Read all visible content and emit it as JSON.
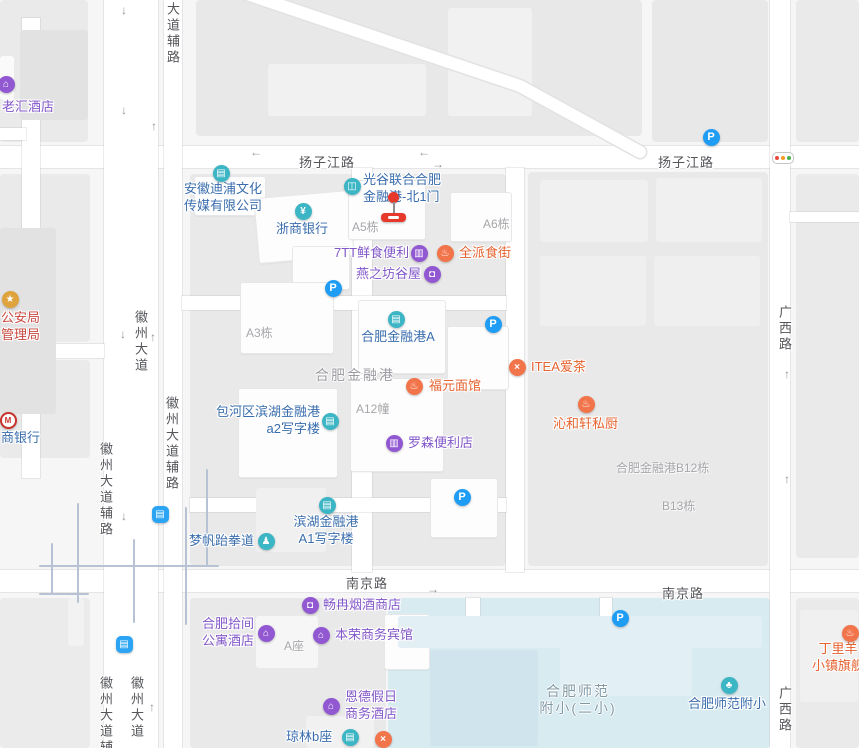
{
  "app": {
    "name": "map-view"
  },
  "colors": {
    "background": "#f6f6f7",
    "block": "#eaeaeb",
    "road": "#ffffff",
    "school_area": "#d8ebf1",
    "alley_line": "#b7c2d4",
    "poi_blue": "#3a6dad",
    "poi_purple": "#8257c8",
    "poi_orange": "#e5622f",
    "poi_red": "#c8473e",
    "icon_teal": "#3cb5c4",
    "icon_purple": "#9158d2",
    "icon_orange": "#f2744b",
    "icon_parking_blue": "#1f9cf3",
    "icon_bus_blue": "#2ba4f4",
    "icon_gov_gold": "#dfa33d",
    "marker_red": "#e6382b"
  },
  "road_labels": [
    {
      "name": "yangzijiang-road-label-west",
      "text": "扬子江路",
      "x": 299,
      "y": 160,
      "vertical": false
    },
    {
      "name": "yangzijiang-road-label-east",
      "text": "扬子江路",
      "x": 658,
      "y": 160,
      "vertical": false
    },
    {
      "name": "nanjing-road-label-west",
      "text": "南京路",
      "x": 346,
      "y": 581,
      "vertical": false
    },
    {
      "name": "nanjing-road-label-east",
      "text": "南京路",
      "x": 662,
      "y": 591,
      "vertical": false
    },
    {
      "name": "huizhou-avenue-label-mid",
      "text": "徽州大道",
      "x": 139,
      "y": 310,
      "vertical": true
    },
    {
      "name": "huizhou-avenue-label-south",
      "text": "徽州大道",
      "x": 135,
      "y": 676,
      "vertical": true
    },
    {
      "name": "huizhou-aux-road-label-top",
      "text": "大道辅路",
      "x": 171,
      "y": 2,
      "vertical": true
    },
    {
      "name": "huizhou-aux-road-label-mid-east",
      "text": "徽州大道辅路",
      "x": 170,
      "y": 396,
      "vertical": true
    },
    {
      "name": "huizhou-aux-road-label-mid-west",
      "text": "徽州大道辅路",
      "x": 104,
      "y": 442,
      "vertical": true
    },
    {
      "name": "huizhou-aux-road-label-south",
      "text": "徽州大道辅路",
      "x": 104,
      "y": 676,
      "vertical": true
    },
    {
      "name": "guangxi-road-label-mid",
      "text": "广西路",
      "x": 783,
      "y": 305,
      "vertical": true
    },
    {
      "name": "guangxi-road-label-south",
      "text": "广西路",
      "x": 783,
      "y": 686,
      "vertical": true
    }
  ],
  "area_labels": [
    {
      "name": "jinronggang-area-label",
      "lines": [
        "合肥金融港"
      ],
      "x": 315,
      "y": 374,
      "size": 14,
      "align": "left",
      "cls": ""
    },
    {
      "name": "school-area-label",
      "lines": [
        "合肥师范",
        "附小(二小)"
      ],
      "x": 578,
      "y": 690,
      "size": 14,
      "align": "center",
      "cls": "c-school"
    }
  ],
  "building_labels": [
    {
      "name": "building-label-a5",
      "text": "A5栋",
      "x": 352,
      "y": 225
    },
    {
      "name": "building-label-a6",
      "text": "A6栋",
      "x": 483,
      "y": 222
    },
    {
      "name": "building-label-a3",
      "text": "A3栋",
      "x": 246,
      "y": 331
    },
    {
      "name": "building-label-a12",
      "text": "A12幢",
      "x": 356,
      "y": 407
    },
    {
      "name": "building-label-b12",
      "text": "合肥金融港B12栋",
      "x": 616,
      "y": 466
    },
    {
      "name": "building-label-b13",
      "text": "B13栋",
      "x": 662,
      "y": 504
    },
    {
      "name": "building-label-a-zuo",
      "text": "A座",
      "x": 284,
      "y": 644
    }
  ],
  "pois": [
    {
      "name": "poi-laohui-hotel",
      "lines": [
        "老汇酒店"
      ],
      "tx": 2,
      "ty": 107,
      "align": "left",
      "cls": "c-purple",
      "icon": {
        "type": "hotel",
        "style": "purple",
        "x": 6,
        "y": 84
      }
    },
    {
      "name": "poi-anhui-dipu-media",
      "lines": [
        "安徽迪浦文化",
        "传媒有限公司"
      ],
      "tx": 184,
      "ty": 189,
      "align": "left",
      "cls": "c-blue",
      "icon": {
        "type": "company",
        "style": "teal",
        "x": 221,
        "y": 173
      }
    },
    {
      "name": "poi-zheshang-bank",
      "lines": [
        "浙商银行"
      ],
      "tx": 302,
      "ty": 229,
      "align": "center",
      "cls": "c-blue",
      "icon": {
        "type": "bank",
        "style": "teal",
        "x": 303,
        "y": 211
      }
    },
    {
      "name": "poi-guanggu-north-gate",
      "lines": [
        "光谷联合合肥",
        "金融港-北1门"
      ],
      "tx": 363,
      "ty": 180,
      "align": "left",
      "cls": "c-blue",
      "icon": {
        "type": "entrance",
        "style": "teal",
        "x": 352,
        "y": 186
      }
    },
    {
      "name": "poi-7tt-convenience",
      "lines": [
        "7TT鲜食便利"
      ],
      "tx": 334,
      "ty": 253,
      "align": "left",
      "cls": "c-purple",
      "icon": {
        "type": "convenience",
        "style": "purple",
        "x": 419,
        "y": 253
      }
    },
    {
      "name": "poi-quanpai-food-street",
      "lines": [
        "全派食街"
      ],
      "tx": 459,
      "ty": 253,
      "align": "left",
      "cls": "c-orange",
      "icon": {
        "type": "food",
        "style": "orange",
        "x": 445,
        "y": 253
      }
    },
    {
      "name": "poi-yanzhifang-guwu",
      "lines": [
        "燕之坊谷屋"
      ],
      "tx": 356,
      "ty": 274,
      "align": "left",
      "cls": "c-purple",
      "icon": {
        "type": "bag",
        "style": "purple",
        "x": 432,
        "y": 274
      }
    },
    {
      "name": "poi-jinronggang-a",
      "lines": [
        "合肥金融港A"
      ],
      "tx": 398,
      "ty": 337,
      "align": "center",
      "cls": "c-blue",
      "icon": {
        "type": "office",
        "style": "teal",
        "x": 396,
        "y": 319
      }
    },
    {
      "name": "poi-baohe-a2-office",
      "lines": [
        "包河区滨湖金融港",
        "a2写字楼"
      ],
      "tx": 320,
      "ty": 412,
      "align": "right",
      "cls": "c-blue",
      "icon": {
        "type": "office",
        "style": "teal",
        "x": 330,
        "y": 421
      }
    },
    {
      "name": "poi-fuyuan-noodle",
      "lines": [
        "福元面馆"
      ],
      "tx": 429,
      "ty": 386,
      "align": "left",
      "cls": "c-orange",
      "icon": {
        "type": "food",
        "style": "orange",
        "x": 414,
        "y": 386
      }
    },
    {
      "name": "poi-itea",
      "lines": [
        "ITEA爱茶"
      ],
      "tx": 531,
      "ty": 367,
      "align": "left",
      "cls": "c-orange",
      "icon": {
        "type": "tea",
        "style": "orange",
        "x": 517,
        "y": 367
      }
    },
    {
      "name": "poi-qinhexuan-kitchen",
      "lines": [
        "沁和轩私厨"
      ],
      "tx": 553,
      "ty": 424,
      "align": "left",
      "cls": "c-orange",
      "icon": {
        "type": "food",
        "style": "orange",
        "x": 586,
        "y": 404
      }
    },
    {
      "name": "poi-lawson",
      "lines": [
        "罗森便利店"
      ],
      "tx": 408,
      "ty": 443,
      "align": "left",
      "cls": "c-purple",
      "icon": {
        "type": "convenience",
        "style": "purple",
        "x": 394,
        "y": 443
      }
    },
    {
      "name": "poi-mengfan-taekwondo",
      "lines": [
        "梦帆跆拳道"
      ],
      "tx": 189,
      "ty": 541,
      "align": "left",
      "cls": "c-blue",
      "icon": {
        "type": "taekwondo",
        "style": "teal",
        "x": 266,
        "y": 541
      }
    },
    {
      "name": "poi-binhu-a1-office",
      "lines": [
        "滨湖金融港",
        "A1写字楼"
      ],
      "tx": 326,
      "ty": 522,
      "align": "center",
      "cls": "c-blue",
      "icon": {
        "type": "office",
        "style": "teal",
        "x": 327,
        "y": 505
      }
    },
    {
      "name": "poi-changran-tobacco",
      "lines": [
        "畅冉烟酒商店"
      ],
      "tx": 323,
      "ty": 605,
      "align": "left",
      "cls": "c-purple",
      "icon": {
        "type": "bag",
        "style": "purple",
        "x": 310,
        "y": 605
      }
    },
    {
      "name": "poi-hefei-shijian-apartment",
      "lines": [
        "合肥拾间",
        "公寓酒店"
      ],
      "tx": 254,
      "ty": 624,
      "align": "right",
      "cls": "c-purple",
      "icon": {
        "type": "hotel",
        "style": "purple",
        "x": 266,
        "y": 633
      }
    },
    {
      "name": "poi-benrong-hotel",
      "lines": [
        "本荣商务宾馆"
      ],
      "tx": 335,
      "ty": 635,
      "align": "left",
      "cls": "c-purple",
      "icon": {
        "type": "hotel",
        "style": "purple",
        "x": 321,
        "y": 635
      }
    },
    {
      "name": "poi-ende-hotel",
      "lines": [
        "恩德假日",
        "商务酒店"
      ],
      "tx": 345,
      "ty": 697,
      "align": "left",
      "cls": "c-purple",
      "icon": {
        "type": "hotel",
        "style": "purple",
        "x": 331,
        "y": 706
      }
    },
    {
      "name": "poi-qionglin-b",
      "lines": [
        "琼林b座"
      ],
      "tx": 286,
      "ty": 737,
      "align": "left",
      "cls": "c-blue",
      "icon": {
        "type": "office",
        "style": "teal",
        "x": 350,
        "y": 737
      }
    },
    {
      "name": "poi-restaurant-cutoff",
      "lines": [],
      "tx": 0,
      "ty": 0,
      "align": "left",
      "cls": "c-orange",
      "icon": {
        "type": "tea",
        "style": "orange",
        "x": 383,
        "y": 739
      }
    },
    {
      "name": "poi-dingliyang-flagship",
      "lines": [
        "丁里羊",
        "小镇旗舰"
      ],
      "tx": 838,
      "ty": 649,
      "align": "center",
      "cls": "c-orange",
      "icon": {
        "type": "food",
        "style": "orange",
        "x": 850,
        "y": 633
      }
    },
    {
      "name": "poi-hefei-shifan-fuxiao",
      "lines": [
        "合肥师范附小"
      ],
      "tx": 688,
      "ty": 704,
      "align": "left",
      "cls": "c-blue",
      "icon": {
        "type": "school",
        "style": "teal",
        "x": 729,
        "y": 685
      }
    },
    {
      "name": "poi-public-security-bureau",
      "lines": [
        "公安局",
        "管理局"
      ],
      "tx": 1,
      "ty": 318,
      "align": "left",
      "cls": "c-red",
      "icon": {
        "type": "gov",
        "style": "gold",
        "x": 10,
        "y": 299
      }
    },
    {
      "name": "poi-zhaoshang-bank",
      "lines": [
        "商银行"
      ],
      "tx": 1,
      "ty": 438,
      "align": "left",
      "cls": "c-blue",
      "icon": {
        "type": "cmb",
        "style": "cmb",
        "x": 8,
        "y": 420
      }
    }
  ],
  "badges": [
    {
      "name": "parking-icon-yangzijiang",
      "type": "parking",
      "x": 711,
      "y": 137
    },
    {
      "name": "parking-icon-yanzhifang",
      "type": "parking",
      "x": 333,
      "y": 288
    },
    {
      "name": "parking-icon-jinronggang-a",
      "type": "parking",
      "x": 493,
      "y": 324
    },
    {
      "name": "parking-icon-binhu",
      "type": "parking",
      "x": 462,
      "y": 497
    },
    {
      "name": "parking-icon-school",
      "type": "parking",
      "x": 620,
      "y": 618
    },
    {
      "name": "bus-stop-icon-huizhou-mid",
      "type": "bus",
      "x": 160,
      "y": 514
    },
    {
      "name": "bus-stop-icon-huizhou-south",
      "type": "bus",
      "x": 124,
      "y": 644
    }
  ],
  "arrows": [
    {
      "glyph": "↓",
      "x": 121,
      "y": 4
    },
    {
      "glyph": "↓",
      "x": 121,
      "y": 104
    },
    {
      "glyph": "↑",
      "x": 151,
      "y": 120
    },
    {
      "glyph": "↓",
      "x": 120,
      "y": 328
    },
    {
      "glyph": "↑",
      "x": 150,
      "y": 331
    },
    {
      "glyph": "↓",
      "x": 121,
      "y": 510
    },
    {
      "glyph": "↑",
      "x": 149,
      "y": 701
    },
    {
      "glyph": "←",
      "x": 250,
      "y": 146
    },
    {
      "glyph": "←",
      "x": 418,
      "y": 146
    },
    {
      "glyph": "→",
      "x": 432,
      "y": 158
    },
    {
      "glyph": "→",
      "x": 427,
      "y": 583
    },
    {
      "glyph": "↑",
      "x": 784,
      "y": 368
    },
    {
      "glyph": "↑",
      "x": 784,
      "y": 473
    }
  ],
  "marker": {
    "name": "destination-marker",
    "x": 381,
    "y": 192
  },
  "traffic_signal": {
    "name": "traffic-signal-icon",
    "x": 772,
    "y": 152,
    "dot_colors": [
      "#e5493f",
      "#f59a23",
      "#4caf50"
    ]
  },
  "geometry": {
    "blocks": [
      [
        0,
        0,
        88,
        142,
        "#eaeaeb"
      ],
      [
        196,
        0,
        446,
        136,
        "#e8e8e9"
      ],
      [
        652,
        0,
        116,
        142,
        "#e8e8e9"
      ],
      [
        796,
        0,
        63,
        142,
        "#eaeaeb"
      ],
      [
        0,
        174,
        90,
        168,
        "#eaeaeb"
      ],
      [
        0,
        360,
        90,
        98,
        "#eaeaeb"
      ],
      [
        190,
        174,
        316,
        392,
        "#e9e9ea"
      ],
      [
        528,
        172,
        240,
        394,
        "#e9e9ea"
      ],
      [
        796,
        174,
        63,
        384,
        "#eaeaeb"
      ],
      [
        0,
        598,
        90,
        150,
        "#ebebec"
      ],
      [
        190,
        598,
        196,
        150,
        "#e9e9ea"
      ],
      [
        796,
        598,
        63,
        150,
        "#eaeaeb"
      ],
      [
        388,
        598,
        382,
        150,
        "#d8ebf1"
      ]
    ],
    "buildings": [
      [
        268,
        64,
        158,
        52,
        "#f1f1f2",
        0
      ],
      [
        448,
        8,
        84,
        108,
        "#f1f1f2",
        0
      ],
      [
        20,
        30,
        68,
        90,
        "#e2e2e3",
        0
      ],
      [
        0,
        56,
        14,
        44,
        "#fafafa",
        0
      ],
      [
        0,
        228,
        56,
        186,
        "#e2e2e3",
        0
      ],
      [
        194,
        176,
        70,
        38,
        "white",
        0
      ],
      [
        256,
        194,
        94,
        64,
        "white",
        -5
      ],
      [
        348,
        180,
        76,
        58,
        "white",
        0
      ],
      [
        450,
        192,
        60,
        48,
        "white",
        0
      ],
      [
        292,
        246,
        56,
        42,
        "white",
        0
      ],
      [
        240,
        282,
        92,
        70,
        "white",
        0
      ],
      [
        358,
        300,
        86,
        72,
        "white",
        0
      ],
      [
        447,
        326,
        60,
        62,
        "white",
        0
      ],
      [
        350,
        378,
        92,
        92,
        "white",
        0
      ],
      [
        238,
        388,
        98,
        88,
        "white",
        0
      ],
      [
        256,
        488,
        70,
        64,
        "#f0f0f1",
        0
      ],
      [
        430,
        478,
        66,
        58,
        "white",
        0
      ],
      [
        540,
        180,
        108,
        62,
        "#f0f0f1",
        0
      ],
      [
        656,
        178,
        106,
        64,
        "#f0f0f1",
        0
      ],
      [
        540,
        256,
        106,
        70,
        "#efeff0",
        0
      ],
      [
        654,
        256,
        106,
        70,
        "#efeff0",
        0
      ],
      [
        256,
        616,
        62,
        52,
        "#f6f6f7",
        0
      ],
      [
        384,
        614,
        44,
        54,
        "white",
        0
      ],
      [
        306,
        716,
        68,
        32,
        "#f1f1f2",
        0
      ],
      [
        800,
        610,
        58,
        92,
        "#f0f0f1",
        0
      ],
      [
        68,
        598,
        16,
        48,
        "#f2f2f3",
        0
      ],
      [
        398,
        616,
        364,
        32,
        "#e2eff5",
        0
      ],
      [
        430,
        650,
        108,
        96,
        "#cfe4ec",
        0
      ],
      [
        560,
        626,
        132,
        70,
        "#e2eff5",
        0
      ]
    ],
    "roads": [
      [
        0,
        146,
        859,
        22
      ],
      [
        0,
        570,
        859,
        22
      ],
      [
        104,
        0,
        54,
        748
      ],
      [
        164,
        0,
        18,
        748
      ],
      [
        22,
        18,
        18,
        460
      ],
      [
        770,
        0,
        20,
        748
      ],
      [
        352,
        168,
        20,
        404
      ],
      [
        506,
        168,
        18,
        404
      ],
      [
        182,
        296,
        324,
        14
      ],
      [
        190,
        498,
        316,
        14
      ],
      [
        790,
        212,
        69,
        10
      ],
      [
        0,
        344,
        104,
        14
      ],
      [
        0,
        128,
        26,
        12
      ],
      [
        600,
        598,
        12,
        54
      ],
      [
        676,
        638,
        12,
        46
      ],
      [
        466,
        598,
        14,
        26
      ]
    ],
    "alleys": [
      [
        40,
        566,
        218,
        566
      ],
      [
        78,
        504,
        78,
        602
      ],
      [
        134,
        540,
        134,
        622
      ],
      [
        186,
        508,
        186,
        624
      ],
      [
        207,
        470,
        207,
        566
      ],
      [
        40,
        594,
        88,
        594
      ],
      [
        52,
        544,
        52,
        594
      ]
    ],
    "diagonal_road": [
      [
        247,
        -6
      ],
      [
        520,
        86
      ],
      [
        640,
        152
      ]
    ]
  }
}
